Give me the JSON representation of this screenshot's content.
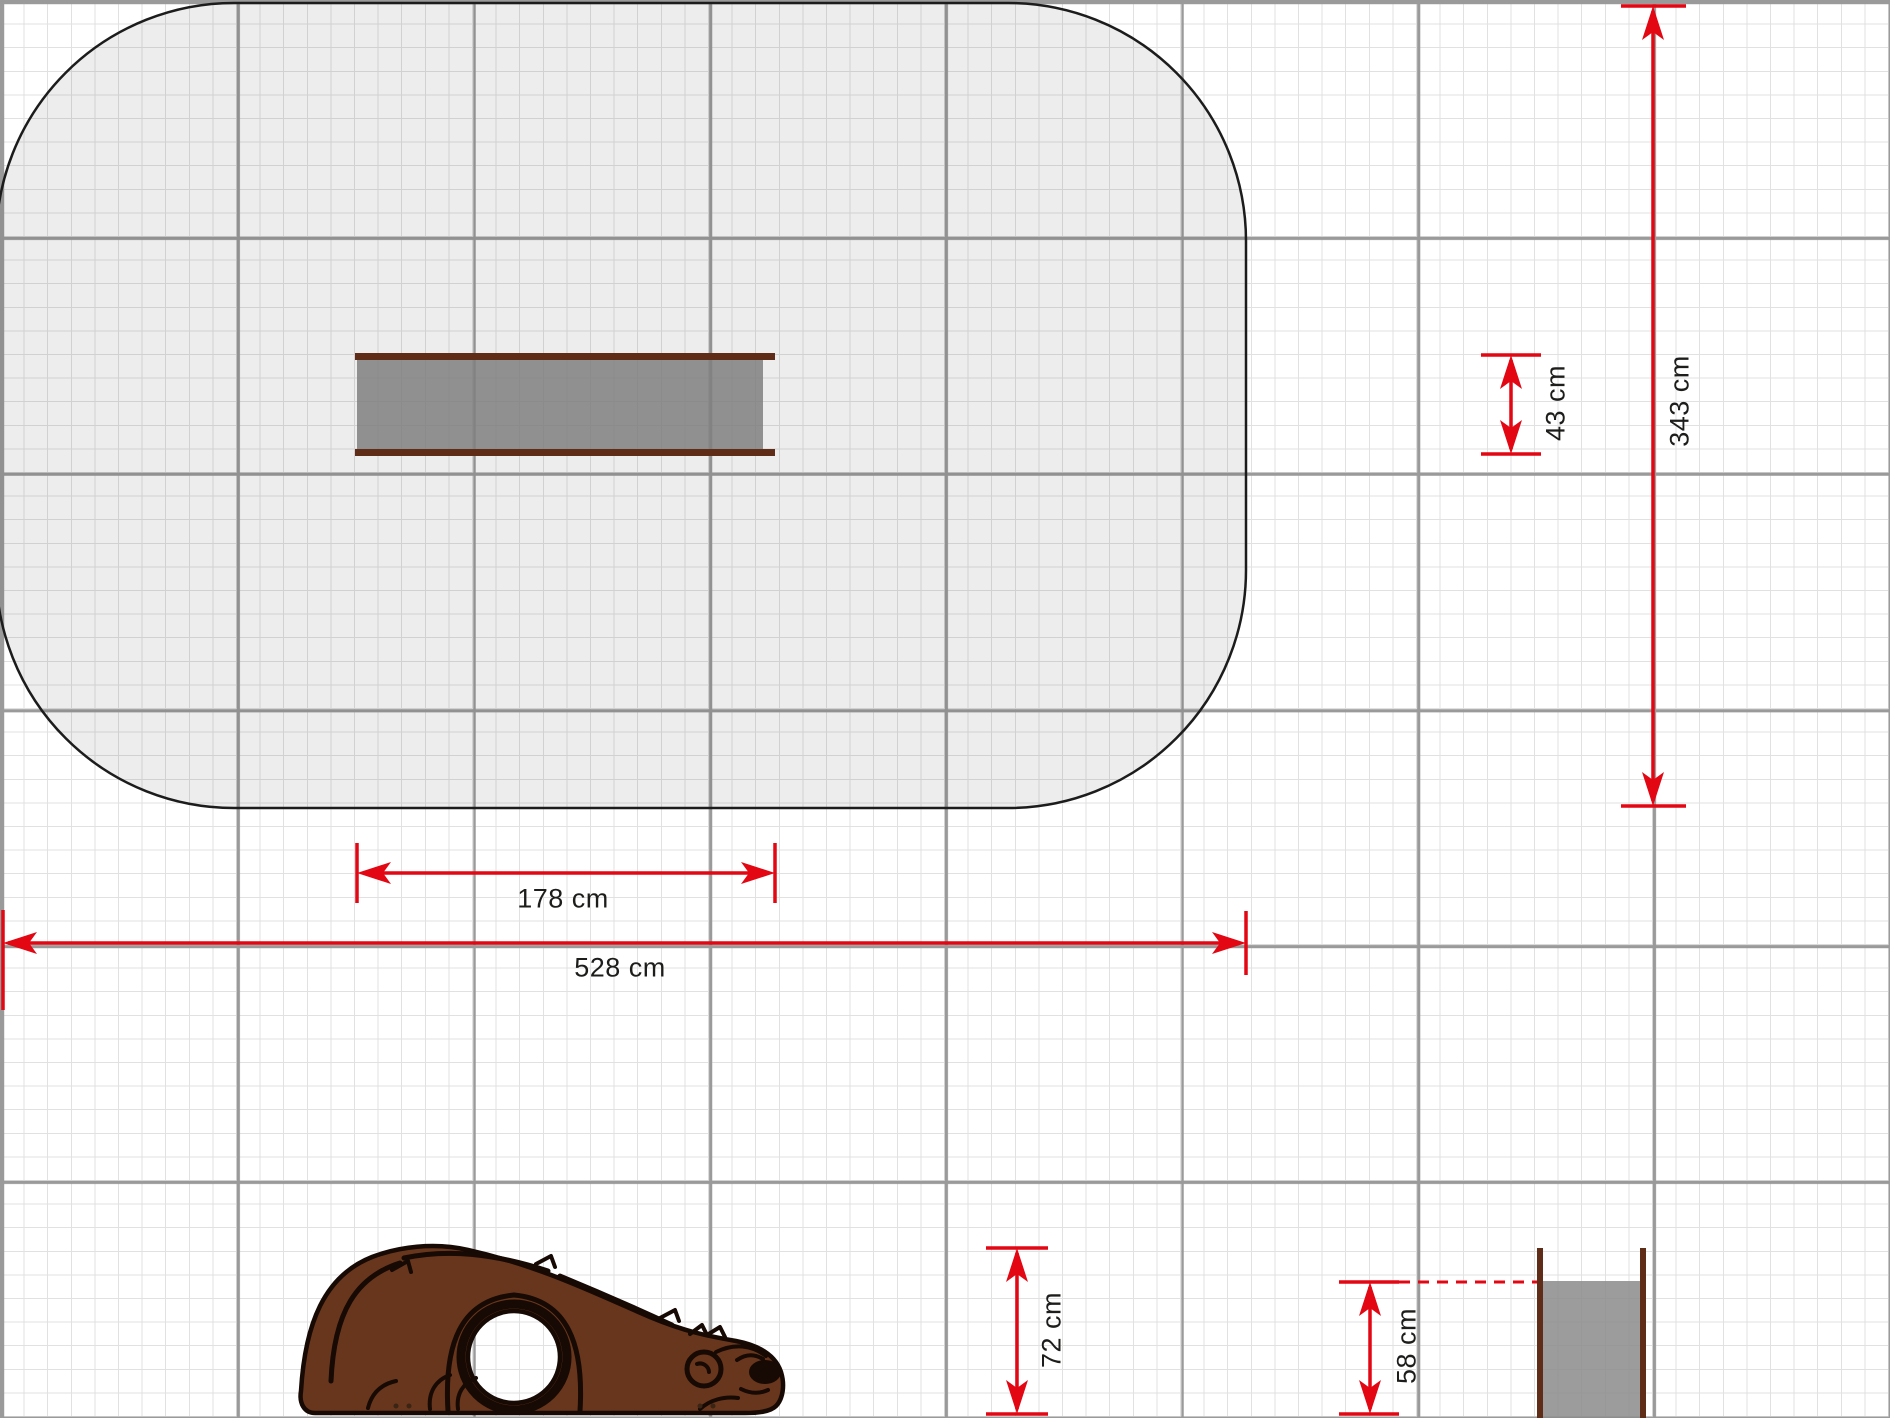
{
  "document": {
    "type": "playground-equipment-technical-drawing",
    "units": "cm",
    "grid": {
      "minor_step_cm": 10,
      "major_step_cm": 100
    }
  },
  "top_view": {
    "safety_zone": {
      "width_label": "528 cm",
      "height_label": "343 cm"
    },
    "equipment": {
      "length_label": "178 cm",
      "depth_label": "43 cm"
    }
  },
  "side_view": {
    "subject": "bear-shaped-play-panel-with-crawl-hole",
    "height_label": "72 cm"
  },
  "front_view": {
    "subject": "panel-between-posts",
    "panel_height_label": "58 cm"
  },
  "colors": {
    "dimension_red": "#e30613",
    "label_text": "#1d1d1b",
    "equipment_brown": "#5e2c17",
    "bear_fill_brown": "#68361c",
    "bear_outline": "#170903",
    "panel_gray": "#8b8b8b",
    "safety_zone_fill": "#e9e9e9",
    "safety_zone_outline": "#1c1c1c",
    "grid_minor": "#e1e1e1",
    "grid_major": "#9a9a9a"
  }
}
